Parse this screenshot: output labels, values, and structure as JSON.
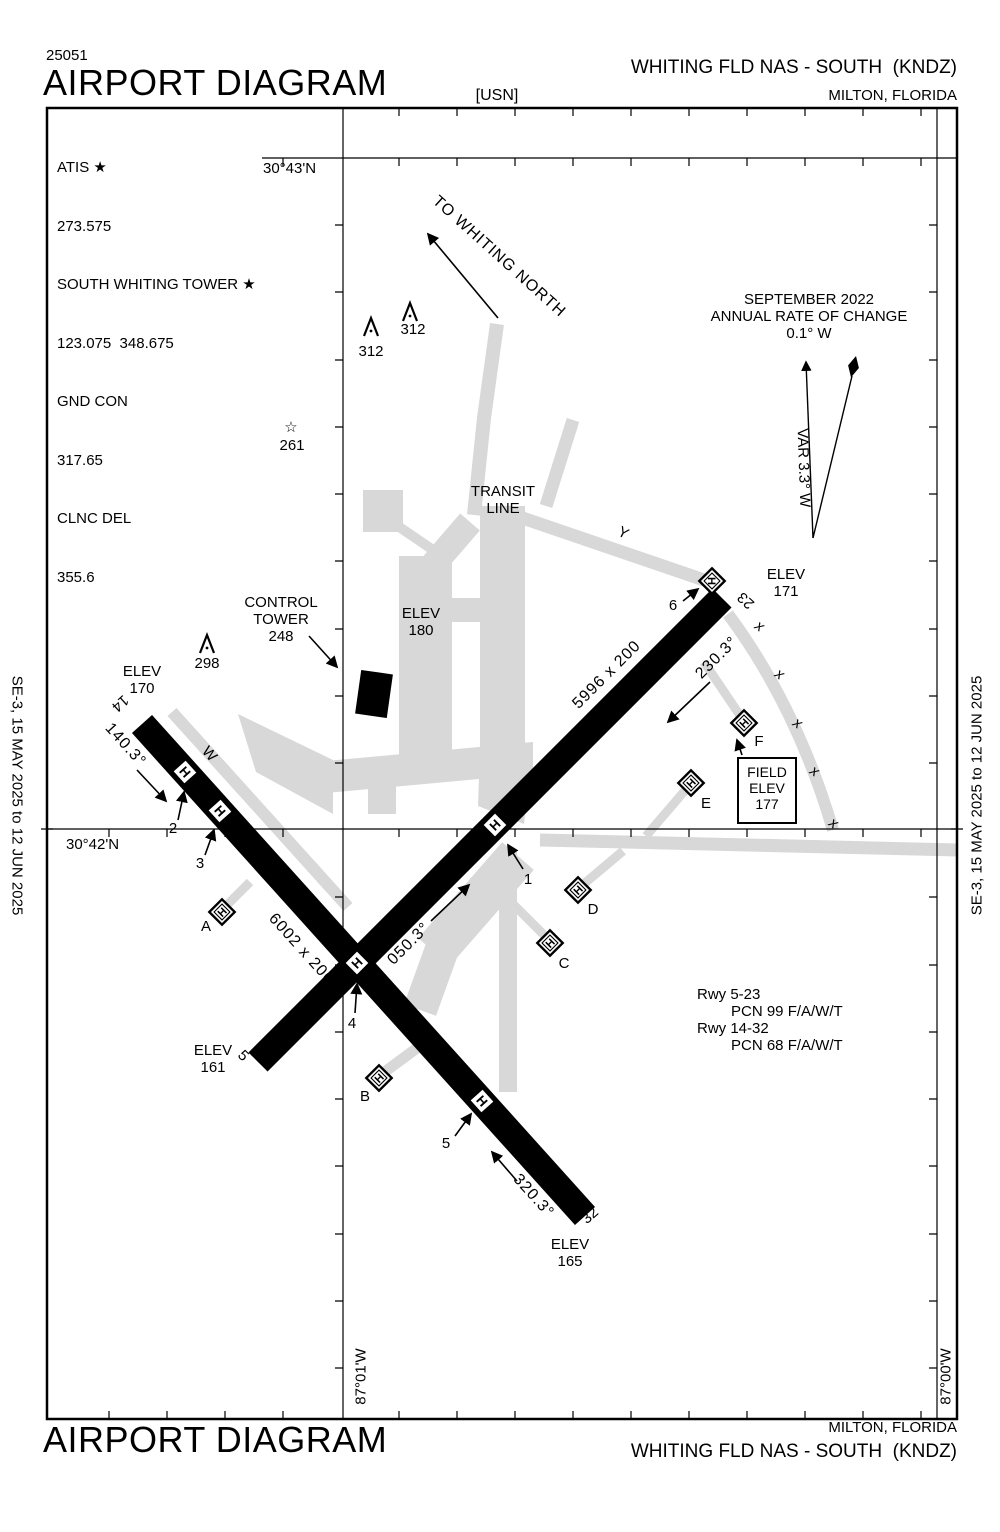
{
  "header": {
    "chart_number": "25051",
    "title": "AIRPORT DIAGRAM",
    "org_label": "[USN]",
    "airport_name": "WHITING FLD NAS - SOUTH  (KNDZ)",
    "city": "MILTON, FLORIDA"
  },
  "footer": {
    "title": "AIRPORT DIAGRAM",
    "city": "MILTON, FLORIDA",
    "airport_name": "WHITING FLD NAS - SOUTH  (KNDZ)"
  },
  "margin_note": "SE-3, 15 MAY 2025 to 12 JUN 2025",
  "comms": {
    "atis_label": "ATIS ★",
    "atis": "273.575",
    "tower_label": "SOUTH WHITING TOWER ★",
    "tower": "123.075  348.675",
    "gnd_label": "GND CON",
    "gnd": "317.65",
    "clnc_label": "CLNC DEL",
    "clnc": "355.6"
  },
  "graticule": {
    "lat_top": "30°43'N",
    "lat_bottom": "30°42'N",
    "lon_w": "87°01'W",
    "lon_e": "87°00'W"
  },
  "magvar": {
    "date": "SEPTEMBER 2022",
    "rate": "ANNUAL RATE OF CHANGE",
    "value": "0.1° W",
    "var_label": "VAR 3.3° W"
  },
  "notes": {
    "to_whiting": "TO WHITING NORTH",
    "transit1": "TRANSIT",
    "transit2": "LINE",
    "ct1": "CONTROL",
    "ct2": "TOWER",
    "ct3": "248",
    "elev180_1": "ELEV",
    "elev180_2": "180",
    "field1": "FIELD",
    "field2": "ELEV",
    "field3": "177",
    "pcn1": "Rwy 5-23",
    "pcn2": "PCN 99 F/A/W/T",
    "pcn3": "Rwy 14-32",
    "pcn4": "PCN 68 F/A/W/T"
  },
  "elevations": {
    "rwy14": {
      "l1": "ELEV",
      "l2": "170"
    },
    "rwy23": {
      "l1": "ELEV",
      "l2": "171"
    },
    "rwy5": {
      "l1": "ELEV",
      "l2": "161"
    },
    "rwy32": {
      "l1": "ELEV",
      "l2": "165"
    }
  },
  "runways": {
    "r1432": {
      "end1": "14",
      "end2": "32",
      "hdg1": "140.3°",
      "hdg2": "320.3°",
      "dim": "6002 x 200"
    },
    "r523": {
      "end1": "5",
      "end2": "23",
      "hdg1": "050.3°",
      "hdg2": "230.3°",
      "dim": "5996 x 200"
    }
  },
  "taxiways": {
    "w": "W",
    "y": "Y"
  },
  "obstacles": {
    "o1": "312",
    "o2": "312",
    "o3": "298",
    "star_elev": "261",
    "star_glyph": "☆"
  },
  "helipads": {
    "h": "H",
    "A": "A",
    "B": "B",
    "C": "C",
    "D": "D",
    "E": "E",
    "F": "F"
  },
  "spots": {
    "s1": "1",
    "s2": "2",
    "s3": "3",
    "s4": "4",
    "s5": "5",
    "s6": "6"
  },
  "closed_mark": "x",
  "colors": {
    "pavement": "#d8d8d8",
    "ink": "#000000"
  }
}
